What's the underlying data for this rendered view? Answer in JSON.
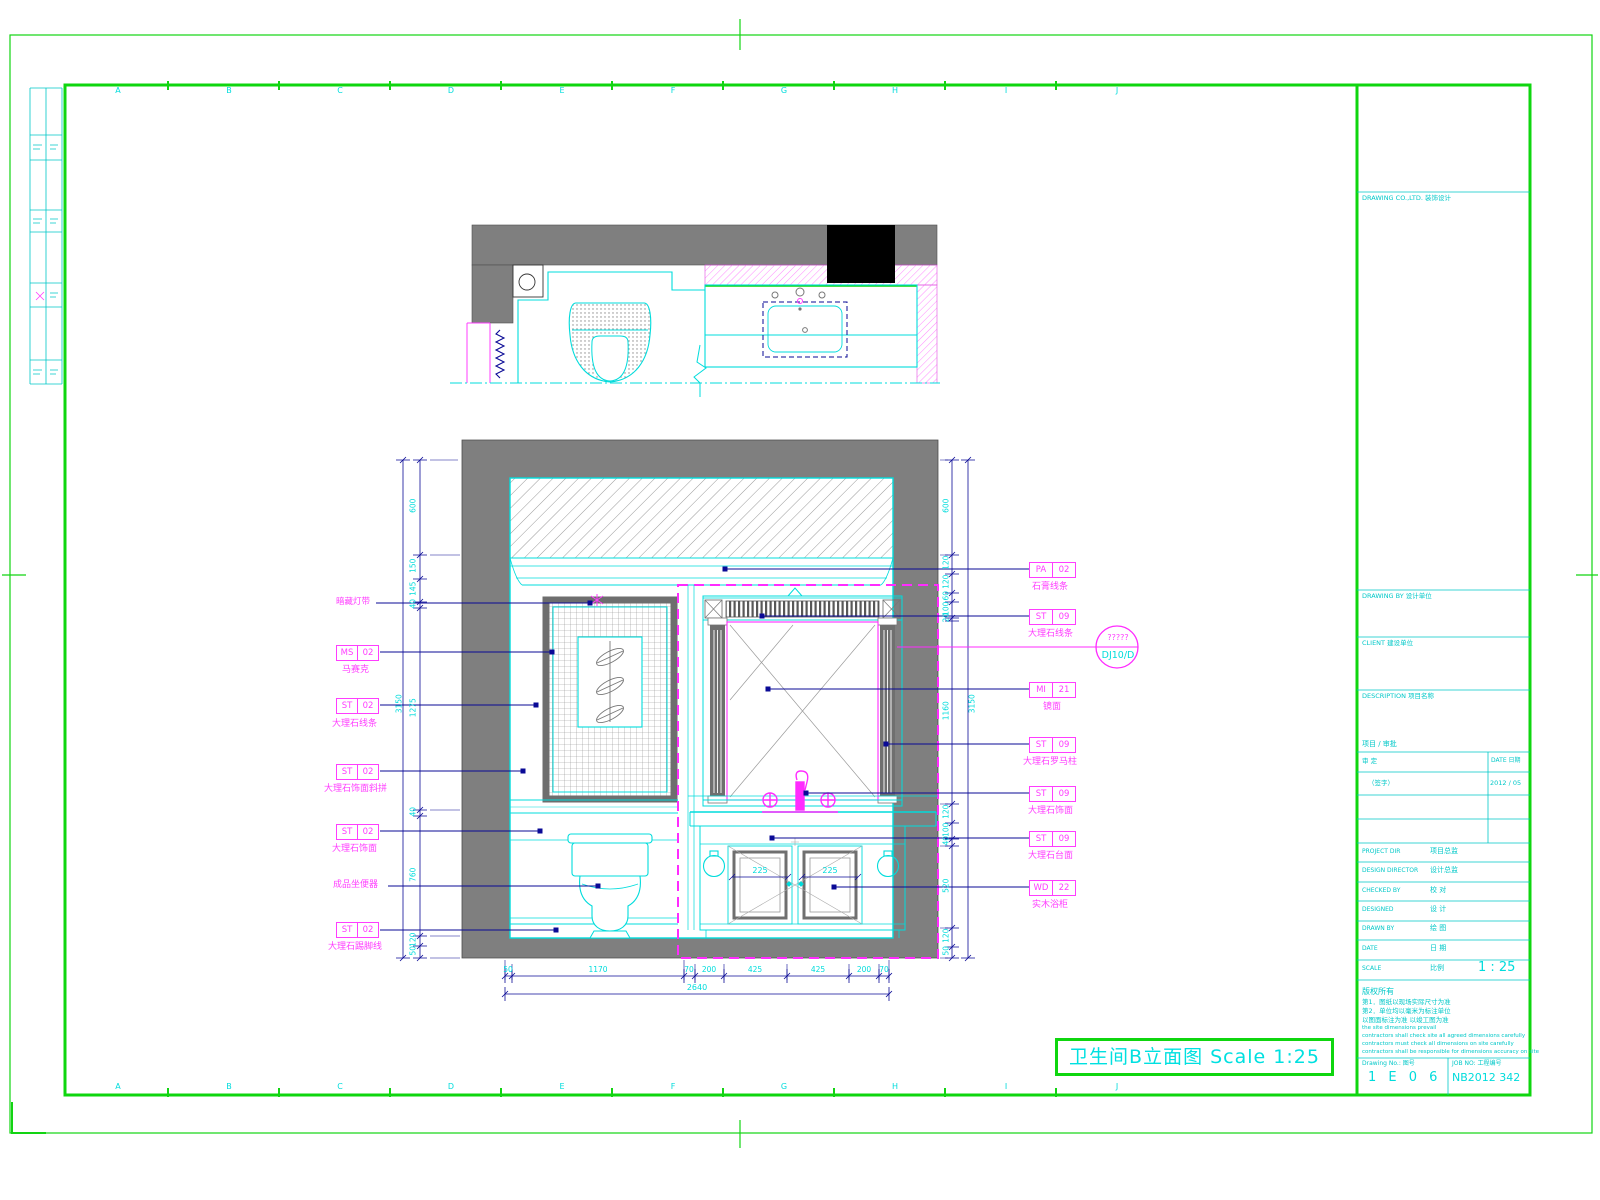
{
  "title_box": {
    "label": "卫生间B立面图 Scale 1:25"
  },
  "detail_bubble": {
    "top": "?????",
    "bottom": "DJ10/D"
  },
  "grid_letters": [
    "A",
    "B",
    "C",
    "D",
    "E",
    "F",
    "G",
    "H",
    "I",
    "J"
  ],
  "left_labels": [
    {
      "text": "暗藏灯带"
    },
    {
      "c1": "MS",
      "c2": "02",
      "text": "马赛克"
    },
    {
      "c1": "ST",
      "c2": "02",
      "text": "大理石线条"
    },
    {
      "c1": "ST",
      "c2": "02",
      "text": "大理石饰面斜拼"
    },
    {
      "c1": "ST",
      "c2": "02",
      "text": "大理石饰面"
    },
    {
      "text": "成品坐便器"
    },
    {
      "c1": "ST",
      "c2": "02",
      "text": "大理石踢脚线"
    }
  ],
  "right_labels": [
    {
      "c1": "PA",
      "c2": "02",
      "text": "石膏线条"
    },
    {
      "c1": "ST",
      "c2": "09",
      "text": "大理石线条"
    },
    {
      "c1": "MI",
      "c2": "21",
      "text": "镜面"
    },
    {
      "c1": "ST",
      "c2": "09",
      "text": "大理石罗马柱"
    },
    {
      "c1": "ST",
      "c2": "09",
      "text": "大理石饰面"
    },
    {
      "c1": "ST",
      "c2": "09",
      "text": "大理石台面"
    },
    {
      "c1": "WD",
      "c2": "22",
      "text": "实木浴柜"
    }
  ],
  "dims": {
    "left_total": "3150",
    "left_segments": [
      "600",
      "150",
      "145",
      "40",
      "1275",
      "40",
      "760",
      "120",
      "50"
    ],
    "right_total": "3150",
    "right_segments": [
      "600",
      "120",
      "120",
      "60",
      "100",
      "20",
      "1160",
      "120",
      "100",
      "40",
      "520",
      "120",
      "50"
    ],
    "bottom_total": "2640",
    "bottom_segments": [
      "50",
      "1170",
      "70",
      "200",
      "425",
      "425",
      "200",
      "70"
    ],
    "door_dims": [
      "225",
      "225"
    ]
  },
  "title_block": {
    "company_row": "DRAWING CO.,LTD.  装饰设计",
    "sec1": "DRAWING BY  设计单位",
    "sec2": "CLIENT  建设单位",
    "sec3": "DESCRIPTION  项目名称",
    "sec4": "项目 / 审批",
    "approval": {
      "h1": "审 定",
      "h2": "DATE 日期",
      "v1": "（签字）",
      "v2": "2012 / 05"
    },
    "info_rows": [
      {
        "en": "PROJECT DIR",
        "cn": "项目总监"
      },
      {
        "en": "DESIGN DIRECTOR",
        "cn": "设计总监"
      },
      {
        "en": "CHECKED BY",
        "cn": "校 对"
      },
      {
        "en": "DESIGNED",
        "cn": "设 计"
      },
      {
        "en": "DRAWN BY",
        "cn": "绘 图"
      },
      {
        "en": "DATE",
        "cn": "日 期"
      },
      {
        "en": "SCALE",
        "cn": "比例"
      }
    ],
    "scale_value": "1 : 25",
    "notes": [
      "版权所有",
      "第1．图纸以现场实际尺寸为准",
      "第2．单位均以毫米为标注单位",
      "以图面标注为准 以竣工图为准",
      "the site dimensions prevail",
      "contractors shall check site all agreed dimensions carefully",
      "contractors must check all dimensions on site carefully",
      "contractors shall be responsible for dimensions accuracy on site"
    ],
    "drawing_no_label": "Drawing No.: 图号",
    "drawing_no": "1 E 0 6",
    "job_label": "JOB NO: 工程编号",
    "job_no": "NB2012 342"
  }
}
